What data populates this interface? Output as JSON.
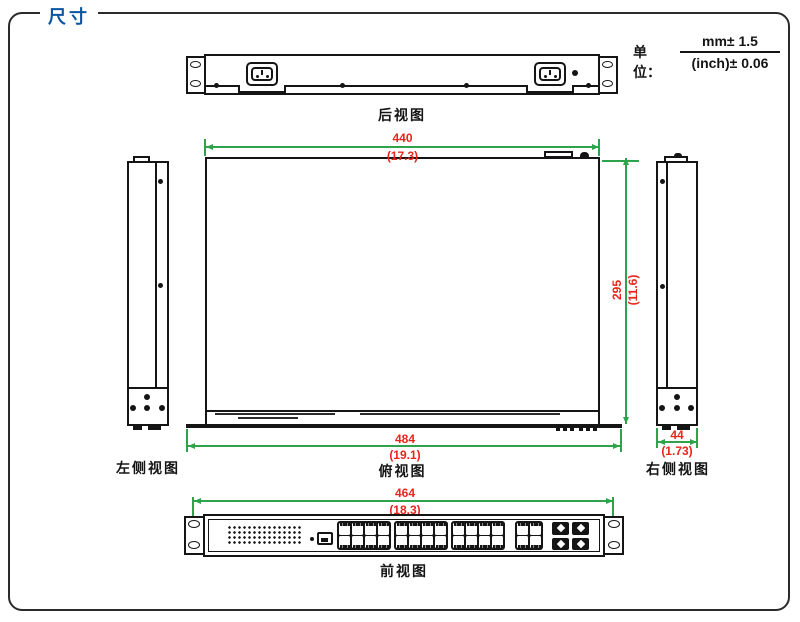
{
  "page": {
    "title": "尺寸",
    "units_label": "单位：",
    "units_mm": "mm± 1.5",
    "units_inch": "(inch)± 0.06"
  },
  "colors": {
    "dimension_line": "#2fa34b",
    "dimension_text": "#e8251d",
    "title_blue": "#0d55a3",
    "line_black": "#151515"
  },
  "views": {
    "rear": {
      "label": "后视图"
    },
    "top": {
      "label": "俯视图",
      "width_mm": "440",
      "width_inch": "(17.3)",
      "depth_mm": "295",
      "depth_inch": "(11.6)",
      "overall_width_mm": "484",
      "overall_width_inch": "(19.1)"
    },
    "left_side": {
      "label": "左侧视图"
    },
    "right_side": {
      "label": "右侧视图",
      "thickness_mm": "44",
      "thickness_inch": "(1.73)"
    },
    "front": {
      "label": "前视图",
      "width_mm": "464",
      "width_inch": "(18.3)",
      "rj45_groups": [
        8,
        8,
        8,
        4
      ],
      "sfp_slots": 4,
      "led_grid": {
        "rows": 4,
        "cols": 15
      }
    }
  }
}
